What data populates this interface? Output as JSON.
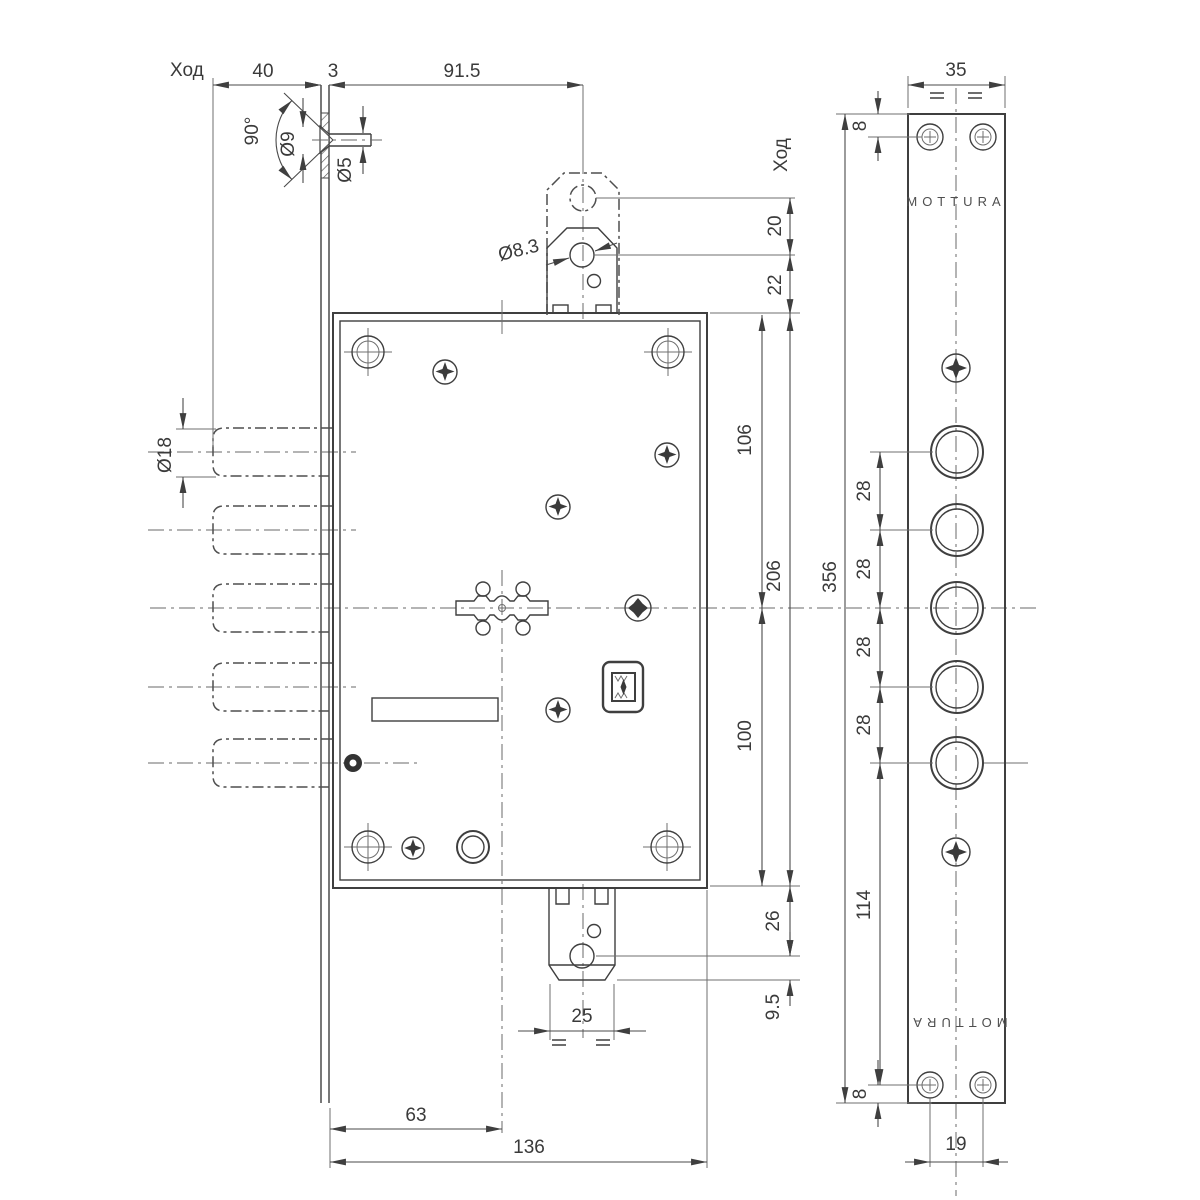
{
  "drawing": {
    "brand_top": "MOTTURA",
    "brand_bottom": "MOTTURA",
    "stroke_label_left": "Ход",
    "stroke_label_right": "Ход",
    "dims": {
      "bolt_travel": "40",
      "faceplate_thickness": "3",
      "latch_offset": "91.5",
      "countersink_angle": "90°",
      "screw_head_dia": "Ø9",
      "screw_hole_dia": "Ø5",
      "latch_hole_dia": "Ø8.3",
      "latch_travel": "20",
      "latch_gap": "22",
      "bolt_dia": "Ø18",
      "top_to_center": "106",
      "body_height": "206",
      "center_to_bottom": "100",
      "aux_offset": "26",
      "aux_tip": "9.5",
      "aux_width": "25",
      "backset": "63",
      "body_depth": "136",
      "plate_width": "35",
      "plate_edge_top": "8",
      "plate_length": "356",
      "hole_pitch": "28",
      "bottom_span": "114",
      "plate_edge_bottom": "8",
      "screw_pitch": "19"
    }
  }
}
